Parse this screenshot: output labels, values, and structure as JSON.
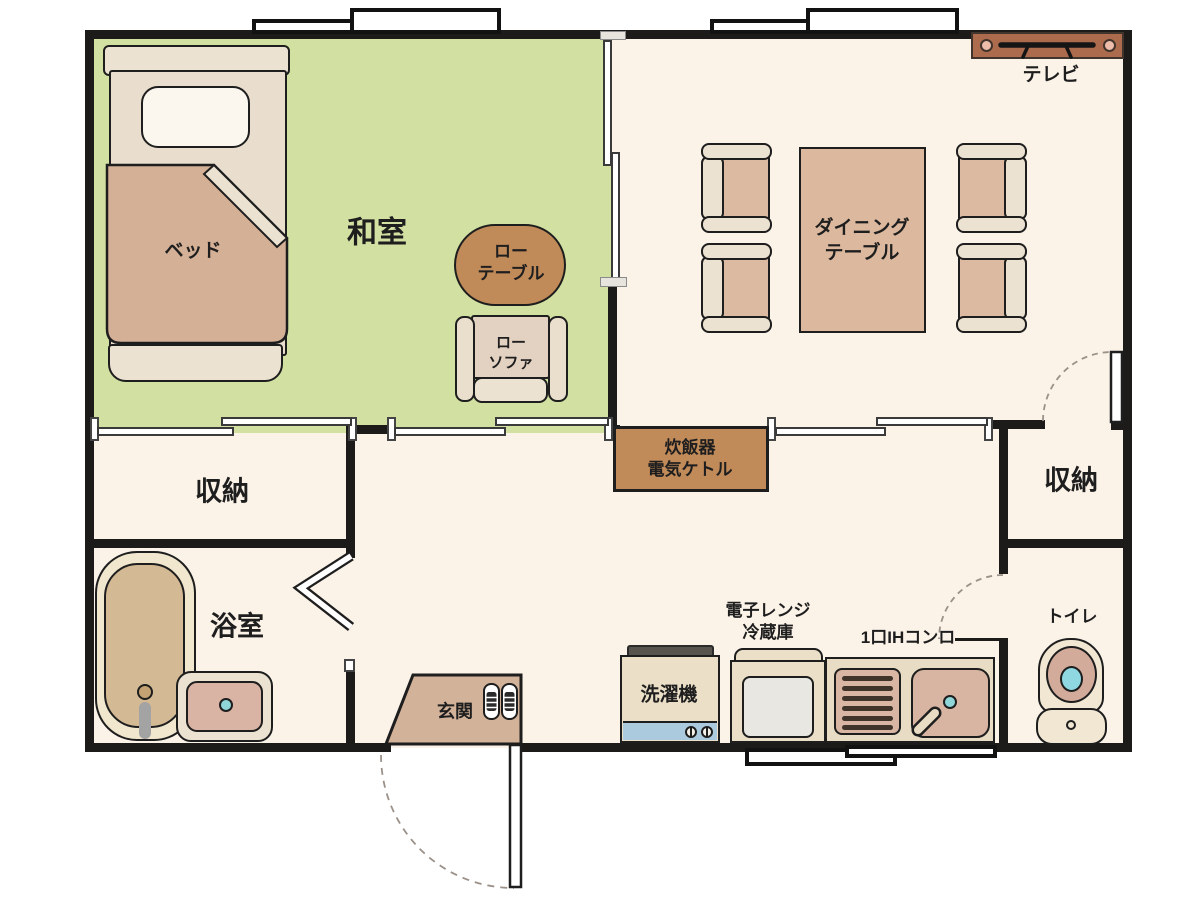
{
  "rooms": {
    "japanese_room": {
      "label": "和室"
    },
    "storage_left": {
      "label": "収納"
    },
    "storage_right": {
      "label": "収納"
    },
    "bathroom": {
      "label": "浴室"
    },
    "entrance": {
      "label": "玄関"
    },
    "toilet": {
      "label": "トイレ"
    }
  },
  "furniture": {
    "bed": {
      "label": "ベッド"
    },
    "low_table": {
      "line1": "ロー",
      "line2": "テーブル"
    },
    "low_sofa": {
      "line1": "ロー",
      "line2": "ソファ"
    },
    "dining_table": {
      "line1": "ダイニング",
      "line2": "テーブル"
    },
    "tv": {
      "label": "テレビ"
    },
    "rice_cooker": {
      "line1": "炊飯器",
      "line2": "電気ケトル"
    },
    "washing_machine": {
      "label": "洗濯機"
    },
    "microwave_fridge": {
      "line1": "電子レンジ",
      "line2": "冷蔵庫"
    },
    "ih_stove": {
      "label": "1口IHコンロ"
    }
  },
  "colors": {
    "wall": "#1d1b19",
    "room": "#fbf2e8",
    "tatami": "#d2e0a2",
    "wood": "#c08a59",
    "tan": "#dcb99e",
    "cream": "#ece2d1",
    "tv": "#ad6b4e",
    "teal": "#8fd6d8",
    "washerblue": "#accadd",
    "text": "#1e1e1e"
  }
}
